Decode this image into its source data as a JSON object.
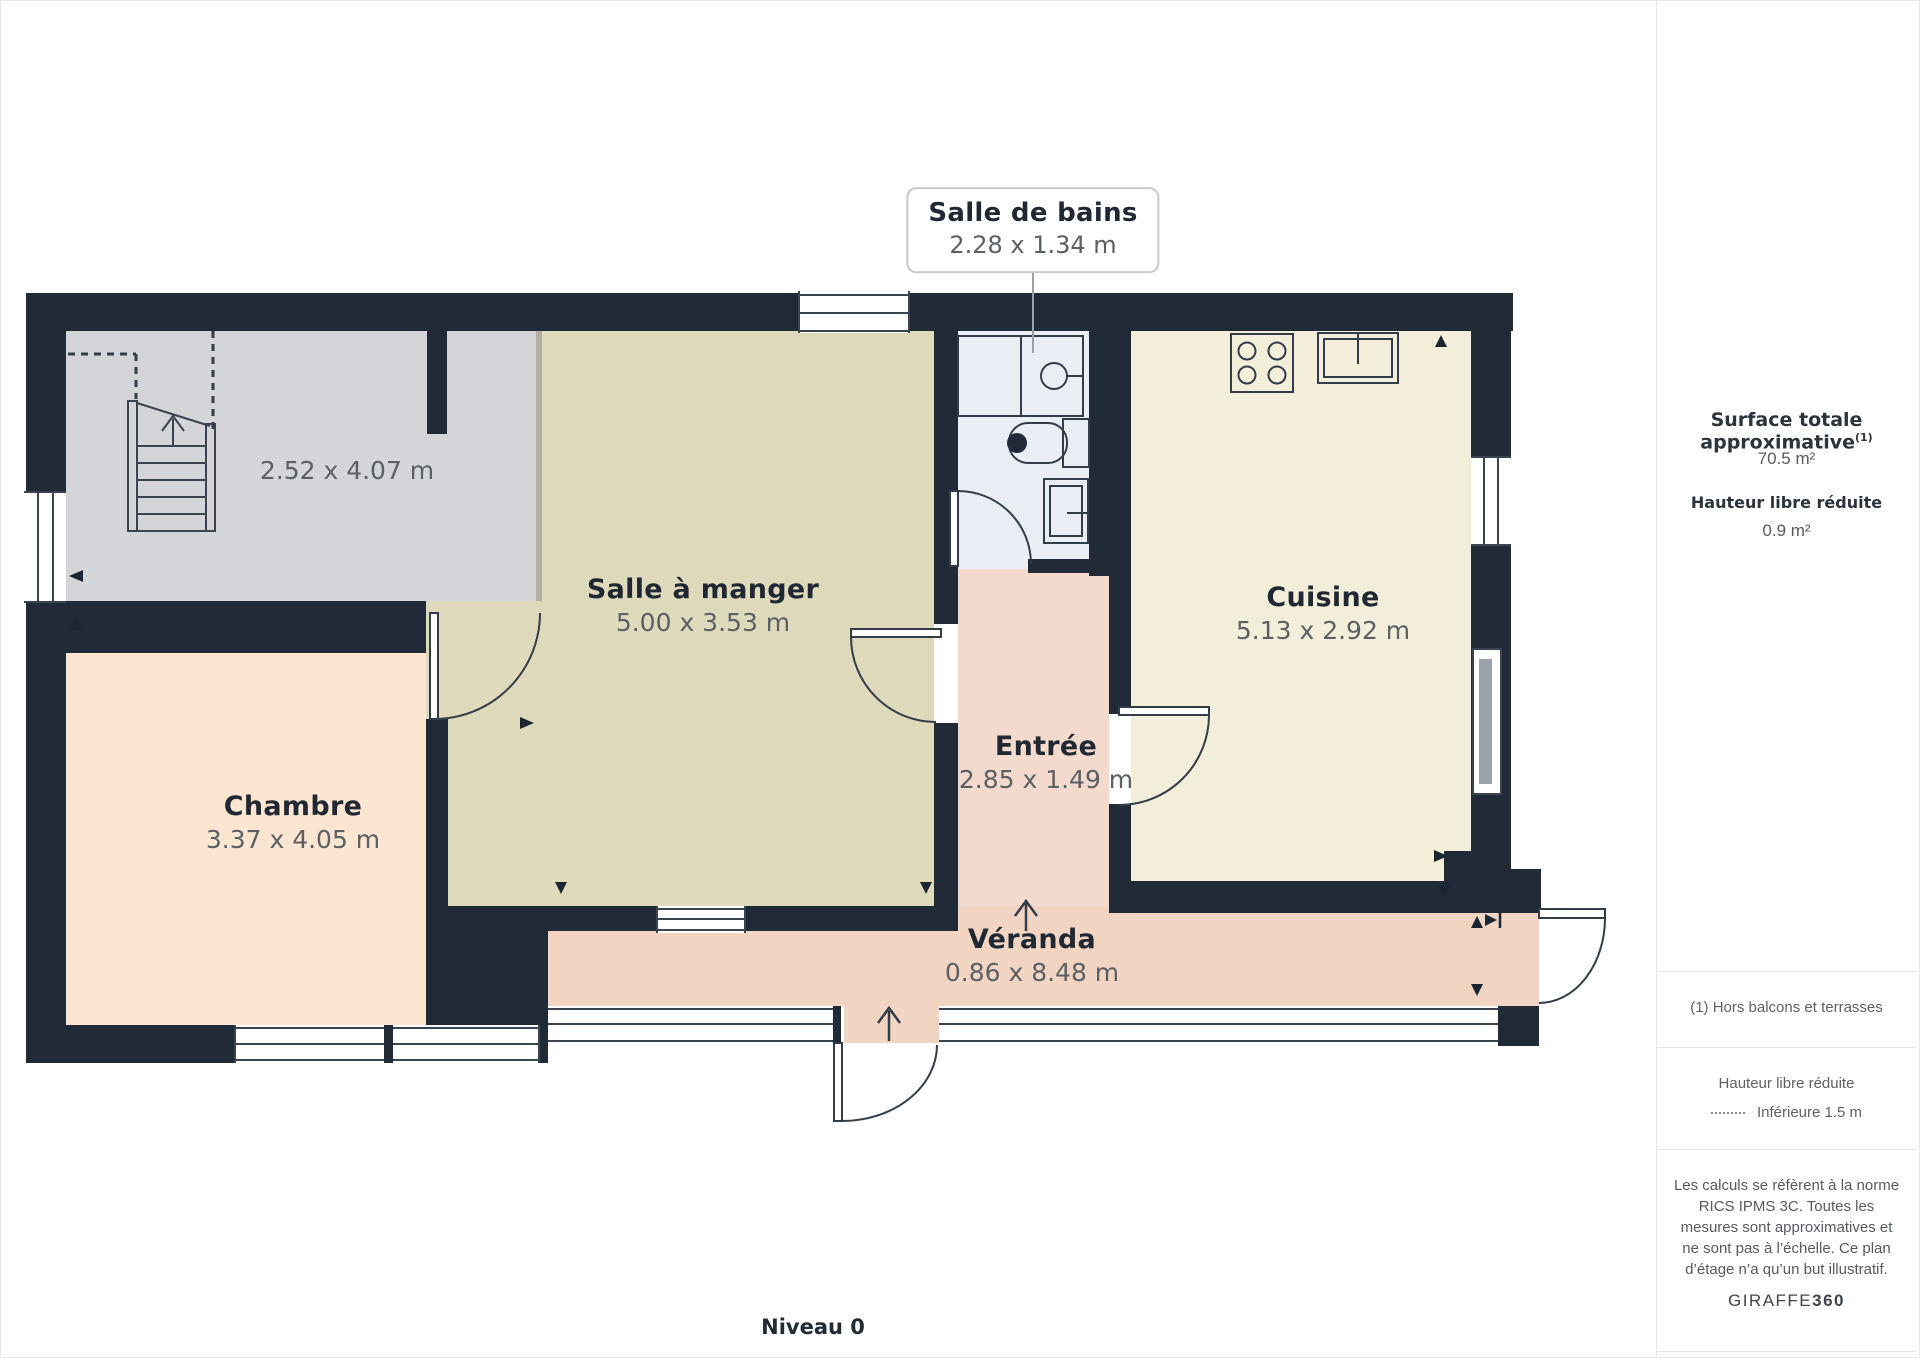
{
  "floor_plan": {
    "level_label": "Niveau 0",
    "wall_color": "#212b38",
    "rooms": [
      {
        "id": "stairs_area",
        "name": "",
        "dimensions": "2.52 x 4.07 m",
        "color": "#d4d5d8"
      },
      {
        "id": "chambre",
        "name": "Chambre",
        "dimensions": "3.37 x 4.05 m",
        "color": "#fce5d1"
      },
      {
        "id": "salle_a_manger",
        "name": "Salle à manger",
        "dimensions": "5.00 x 3.53 m",
        "color": "#ded9bb"
      },
      {
        "id": "salle_de_bains",
        "name": "Salle de bains",
        "dimensions": "2.28 x 1.34 m",
        "color": "#e9eef5"
      },
      {
        "id": "entree",
        "name": "Entrée",
        "dimensions": "2.85 x 1.49 m",
        "color": "#f4d9cd"
      },
      {
        "id": "cuisine",
        "name": "Cuisine",
        "dimensions": "5.13 x 2.92 m",
        "color": "#f2eed9"
      },
      {
        "id": "veranda",
        "name": "Véranda",
        "dimensions": "0.86 x 8.48 m",
        "color": "#f1d4c2"
      }
    ]
  },
  "sidebar": {
    "total_area_label": "Surface totale approximative",
    "total_area_superscript": "(1)",
    "total_area_value": "70.5 m²",
    "reduced_height_label": "Hauteur libre réduite",
    "reduced_height_value": "0.9 m²",
    "footnote": "(1) Hors balcons et terrasses",
    "legend_title": "Hauteur libre réduite",
    "legend_item": "Inférieure 1.5 m",
    "disclaimer": "Les calculs se réfèrent à la norme RICS IPMS 3C. Toutes les mesures sont approximatives et ne sont pas à l’échelle. Ce plan d’étage n’a qu’un but illustratif.",
    "brand_regular": "GIRAFFE",
    "brand_bold": "360"
  }
}
